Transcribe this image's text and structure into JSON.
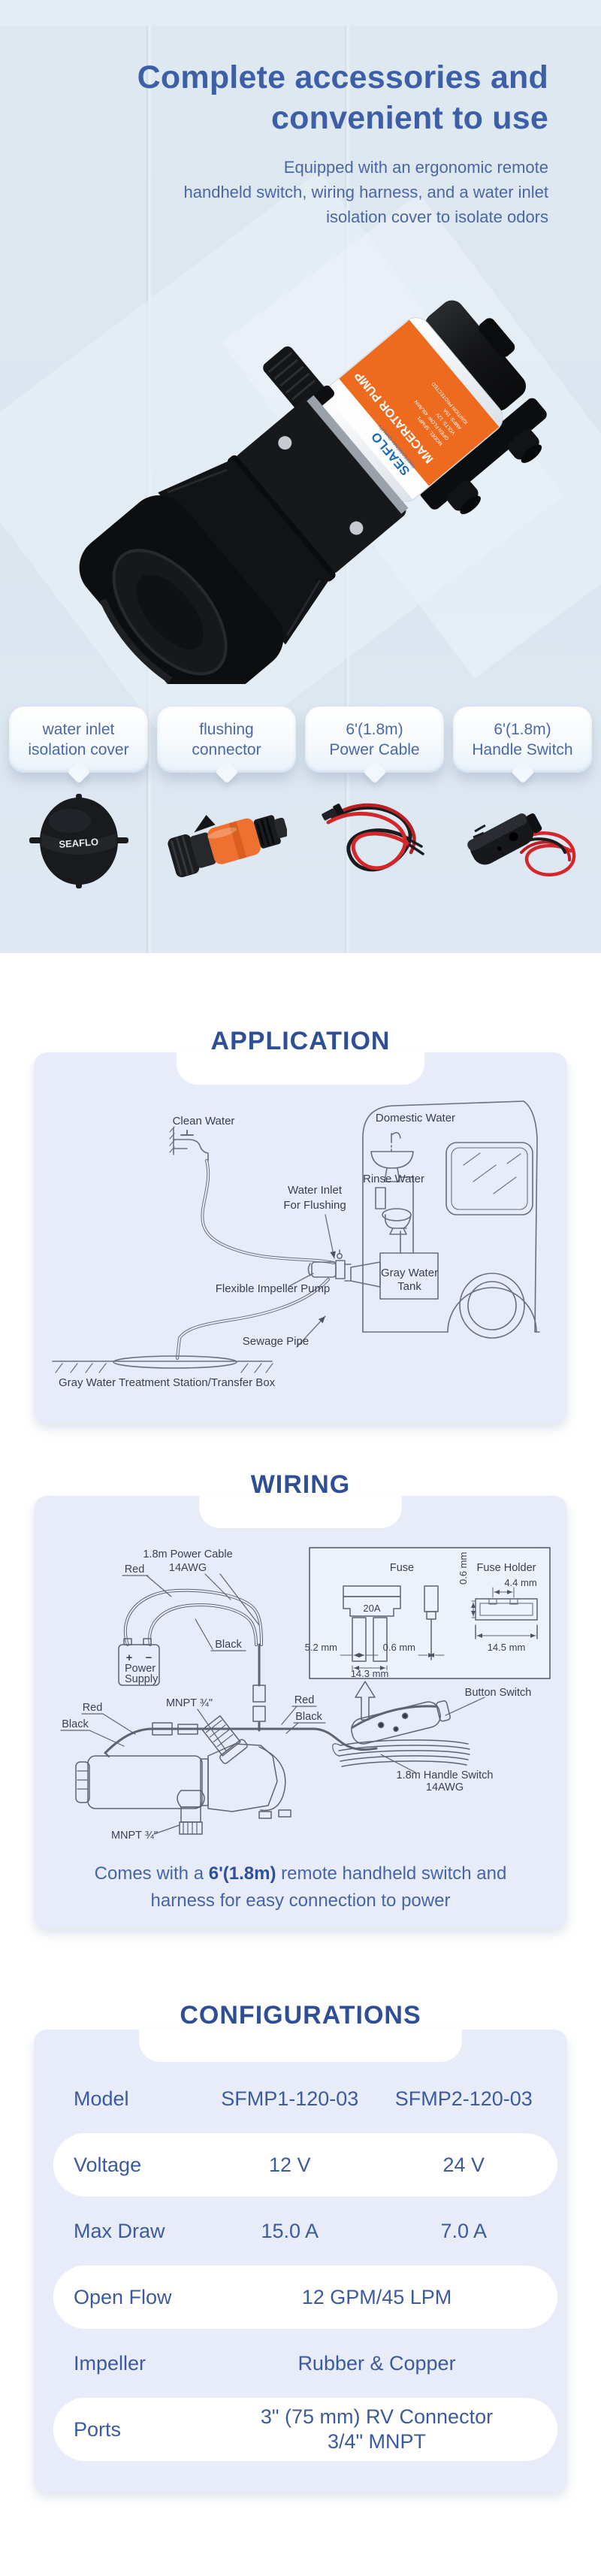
{
  "hero": {
    "title_line1": "Complete accessories and",
    "title_line2": "convenient to use",
    "subtitle_line1": "Equipped with an ergonomic remote",
    "subtitle_line2": "handheld switch, wiring harness, and a water inlet",
    "subtitle_line3": "isolation cover to isolate odors"
  },
  "pump_label": {
    "brand": "SEAFLO",
    "sub_brand": "PROFESSIONAL QUALITY",
    "series": "MACERATOR PUMP",
    "spec1": "MODEL: SFMP1",
    "spec2": "OPEN FLOW: 45L/MIN",
    "spec3": "VOLTS: 12V",
    "spec4": "AMPS: 15A",
    "spec5": "IGNITION PROTECTED"
  },
  "accessories": {
    "cover_brand": "SEAFLO",
    "items": [
      {
        "line1": "water inlet",
        "line2": "isolation cover"
      },
      {
        "line1": "flushing",
        "line2": "connector"
      },
      {
        "line1": "6'(1.8m)",
        "line2": "Power Cable"
      },
      {
        "line1": "6'(1.8m)",
        "line2": "Handle Switch"
      }
    ]
  },
  "application": {
    "title": "APPLICATION",
    "clean_water": "Clean Water",
    "domestic_water": "Domestic Water",
    "rinse_water": "Rinse Water",
    "water_inlet_1": "Water Inlet",
    "water_inlet_2": "For Flushing",
    "pump": "Flexible Impeller Pump",
    "tank_1": "Gray Water",
    "tank_2": "Tank",
    "sewage": "Sewage Pipe",
    "treatment": "Gray Water Treatment Station/Transfer Box"
  },
  "wiring": {
    "title": "WIRING",
    "power_cable_1": "1.8m Power Cable",
    "power_cable_2": "14AWG",
    "red": "Red",
    "black": "Black",
    "plus": "+",
    "minus": "−",
    "power_1": "Power",
    "power_2": "Supply",
    "mnpt": "MNPT ¾\"",
    "fuse": "Fuse",
    "fuse_holder": "Fuse Holder",
    "fuse_rating": "20A",
    "dim_52": "5.2 mm",
    "dim_06": "0.6 mm",
    "dim_143": "14.3 mm",
    "dim_06b": "0.6 mm",
    "dim_44": "4.4 mm",
    "dim_145": "14.5 mm",
    "button_switch": "Button Switch",
    "handle_switch_1": "1.8m Handle Switch",
    "handle_switch_2": "14AWG",
    "caption_pre": "Comes with a ",
    "caption_bold": "6'(1.8m)",
    "caption_post": " remote handheld switch and",
    "caption_line2": "harness for easy connection to power"
  },
  "configurations": {
    "title": "CONFIGURATIONS",
    "rows": [
      {
        "label": "Model",
        "col1": "SFMP1-120-03",
        "col2": "SFMP2-120-03"
      },
      {
        "label": "Voltage",
        "col1": "12 V",
        "col2": "24 V"
      },
      {
        "label": "Max Draw",
        "col1": "15.0 A",
        "col2": "7.0 A"
      },
      {
        "label": "Open Flow",
        "value": "12 GPM/45 LPM"
      },
      {
        "label": "Impeller",
        "value": "Rubber & Copper"
      },
      {
        "label": "Ports",
        "value_1": "3\" (75 mm) RV Connector",
        "value_2": "3/4\" MNPT"
      }
    ]
  },
  "colors": {
    "accent_blue": "#3d5fa7",
    "title_blue": "#2e4f96",
    "panel": "#e7ecf8",
    "orange": "#ed6a1f",
    "wire_red": "#d4272b"
  }
}
